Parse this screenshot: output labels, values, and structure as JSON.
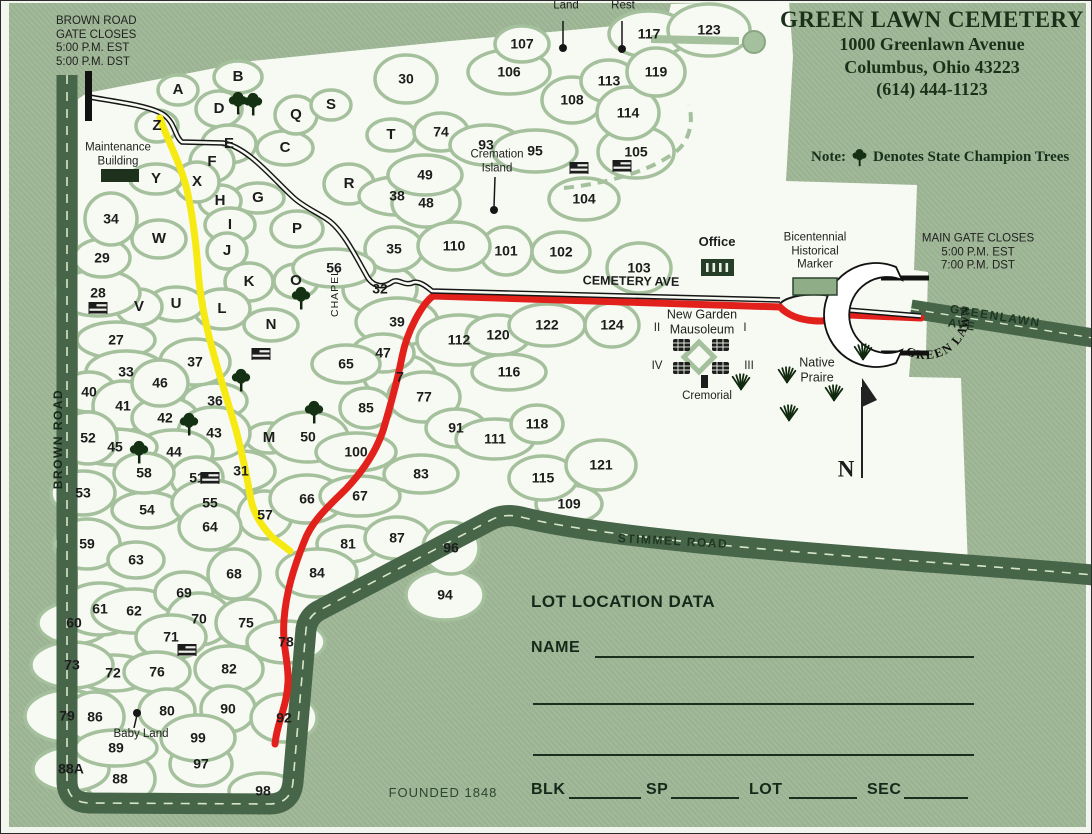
{
  "header": {
    "title": "GREEN LAWN CEMETERY",
    "address": "1000 Greenlawn Avenue",
    "city": "Columbus, Ohio 43223",
    "phone": "(614) 444-1123",
    "note_prefix": "Note:",
    "note_text": "Denotes State Champion Trees"
  },
  "corner_notes": {
    "brown_gate": "BROWN ROAD\nGATE CLOSES\n5:00 P.M. EST\n5:00 P.M. DST",
    "main_gate": "MAIN GATE CLOSES\n5:00 P.M. EST\n7:00 P.M. DST"
  },
  "roads": {
    "brown": "BROWN ROAD",
    "cemetery": "CEMETERY AVE",
    "greenlawn": "GREENLAWN AVE",
    "stimmel": "STIMMEL ROAD",
    "gate_arch": "GREEN LAWN"
  },
  "landmarks": {
    "maintenance": "Maintenance\nBuilding",
    "lullabye": "Lullabye\nLand",
    "baby_rest": "Baby\nRest",
    "cremation_island": "Cremation\nIsland",
    "chapel": "CHAPEL",
    "office": "Office",
    "bicentennial": "Bicentennial\nHistorical\nMarker",
    "mausoleum": "New Garden\nMausoleum",
    "quad_1": "I",
    "quad_2": "II",
    "quad_3": "III",
    "quad_4": "IV",
    "cremorial": "Cremorial",
    "native_prairie": "Native\nPraire",
    "baby_land": "Baby Land",
    "compass": "N",
    "founded": "FOUNDED 1848"
  },
  "form": {
    "title": "LOT LOCATION DATA",
    "name_label": "NAME",
    "blk": "BLK",
    "sp": "SP",
    "lot": "LOT",
    "sec": "SEC"
  },
  "colors": {
    "page_green": "#9db694",
    "map_white": "#f7faf2",
    "cell_line": "#a5c09c",
    "road_dark": "#476549",
    "road_dash": "#d7e6c9",
    "route_red": "#e2211c",
    "route_yellow": "#f6ea12",
    "drive_black": "#161616",
    "text_dark": "#1c1c1c"
  },
  "map": {
    "lots": [
      [
        "A",
        177,
        89
      ],
      [
        "B",
        237,
        76
      ],
      [
        "C",
        284,
        147
      ],
      [
        "D",
        218,
        108
      ],
      [
        "E",
        228,
        143
      ],
      [
        "F",
        211,
        161
      ],
      [
        "G",
        257,
        197
      ],
      [
        "H",
        219,
        200
      ],
      [
        "I",
        229,
        224
      ],
      [
        "J",
        226,
        250
      ],
      [
        "K",
        248,
        281
      ],
      [
        "L",
        221,
        308
      ],
      [
        "M",
        268,
        437
      ],
      [
        "N",
        270,
        324
      ],
      [
        "O",
        295,
        280
      ],
      [
        "P",
        296,
        228
      ],
      [
        "Q",
        295,
        114
      ],
      [
        "R",
        348,
        183
      ],
      [
        "S",
        330,
        104
      ],
      [
        "T",
        390,
        134
      ],
      [
        "U",
        175,
        303
      ],
      [
        "V",
        138,
        306
      ],
      [
        "W",
        158,
        238
      ],
      [
        "X",
        196,
        181
      ],
      [
        "Y",
        155,
        178
      ],
      [
        "Z",
        156,
        125
      ],
      [
        "7",
        399,
        376
      ],
      [
        "27",
        115,
        339
      ],
      [
        "28",
        97,
        292
      ],
      [
        "29",
        101,
        257
      ],
      [
        "30",
        405,
        78
      ],
      [
        "31",
        240,
        470
      ],
      [
        "32",
        379,
        288
      ],
      [
        "33",
        125,
        371
      ],
      [
        "34",
        110,
        218
      ],
      [
        "35",
        393,
        248
      ],
      [
        "36",
        214,
        400
      ],
      [
        "37",
        194,
        361
      ],
      [
        "38",
        396,
        195
      ],
      [
        "39",
        396,
        321
      ],
      [
        "40",
        88,
        391
      ],
      [
        "41",
        122,
        405
      ],
      [
        "42",
        164,
        417
      ],
      [
        "43",
        213,
        432
      ],
      [
        "44",
        173,
        451
      ],
      [
        "45",
        114,
        446
      ],
      [
        "46",
        159,
        382
      ],
      [
        "47",
        382,
        352
      ],
      [
        "48",
        425,
        202
      ],
      [
        "49",
        424,
        174
      ],
      [
        "50",
        307,
        436
      ],
      [
        "51",
        196,
        477
      ],
      [
        "52",
        87,
        437
      ],
      [
        "53",
        82,
        492
      ],
      [
        "54",
        146,
        509
      ],
      [
        "55",
        209,
        502
      ],
      [
        "56",
        333,
        267
      ],
      [
        "57",
        264,
        514
      ],
      [
        "58",
        143,
        472
      ],
      [
        "59",
        86,
        543
      ],
      [
        "60",
        73,
        622
      ],
      [
        "61",
        99,
        608
      ],
      [
        "62",
        133,
        610
      ],
      [
        "63",
        135,
        559
      ],
      [
        "64",
        209,
        526
      ],
      [
        "65",
        345,
        363
      ],
      [
        "66",
        306,
        498
      ],
      [
        "67",
        359,
        495
      ],
      [
        "68",
        233,
        573
      ],
      [
        "69",
        183,
        592
      ],
      [
        "70",
        198,
        618
      ],
      [
        "71",
        170,
        636
      ],
      [
        "72",
        112,
        672
      ],
      [
        "73",
        71,
        664
      ],
      [
        "74",
        440,
        131
      ],
      [
        "75",
        245,
        622
      ],
      [
        "76",
        156,
        671
      ],
      [
        "77",
        423,
        396
      ],
      [
        "78",
        285,
        641
      ],
      [
        "79",
        66,
        715
      ],
      [
        "80",
        166,
        710
      ],
      [
        "81",
        347,
        543
      ],
      [
        "82",
        228,
        668
      ],
      [
        "83",
        420,
        473
      ],
      [
        "84",
        316,
        572
      ],
      [
        "85",
        365,
        407
      ],
      [
        "86",
        94,
        716
      ],
      [
        "87",
        396,
        537
      ],
      [
        "88",
        119,
        778
      ],
      [
        "88A",
        70,
        768
      ],
      [
        "89",
        115,
        747
      ],
      [
        "90",
        227,
        708
      ],
      [
        "91",
        455,
        427
      ],
      [
        "92",
        283,
        717
      ],
      [
        "93",
        485,
        144
      ],
      [
        "94",
        444,
        594
      ],
      [
        "95",
        534,
        150
      ],
      [
        "96",
        450,
        547
      ],
      [
        "97",
        200,
        763
      ],
      [
        "98",
        262,
        790
      ],
      [
        "99",
        197,
        737
      ],
      [
        "100",
        355,
        451
      ],
      [
        "101",
        505,
        250
      ],
      [
        "102",
        560,
        251
      ],
      [
        "103",
        638,
        267
      ],
      [
        "104",
        583,
        198
      ],
      [
        "105",
        635,
        151
      ],
      [
        "106",
        508,
        71
      ],
      [
        "107",
        521,
        43
      ],
      [
        "108",
        571,
        99
      ],
      [
        "109",
        568,
        503
      ],
      [
        "110",
        453,
        245
      ],
      [
        "111",
        494,
        438
      ],
      [
        "112",
        458,
        339
      ],
      [
        "113",
        608,
        80
      ],
      [
        "114",
        627,
        112
      ],
      [
        "115",
        542,
        477
      ],
      [
        "116",
        508,
        371
      ],
      [
        "117",
        648,
        33
      ],
      [
        "118",
        536,
        423
      ],
      [
        "119",
        655,
        71
      ],
      [
        "120",
        497,
        334
      ],
      [
        "121",
        600,
        464
      ],
      [
        "122",
        546,
        324
      ],
      [
        "123",
        708,
        29
      ],
      [
        "124",
        611,
        324
      ]
    ],
    "trees": [
      [
        237,
        102
      ],
      [
        252,
        103
      ],
      [
        300,
        297
      ],
      [
        240,
        379
      ],
      [
        188,
        423
      ],
      [
        138,
        451
      ],
      [
        313,
        411
      ]
    ],
    "flags": [
      [
        97,
        307
      ],
      [
        260,
        353
      ],
      [
        209,
        477
      ],
      [
        186,
        649
      ],
      [
        578,
        167
      ],
      [
        621,
        165
      ]
    ],
    "grass": [
      [
        740,
        381
      ],
      [
        786,
        374
      ],
      [
        833,
        392
      ],
      [
        862,
        351
      ],
      [
        788,
        412
      ]
    ]
  }
}
